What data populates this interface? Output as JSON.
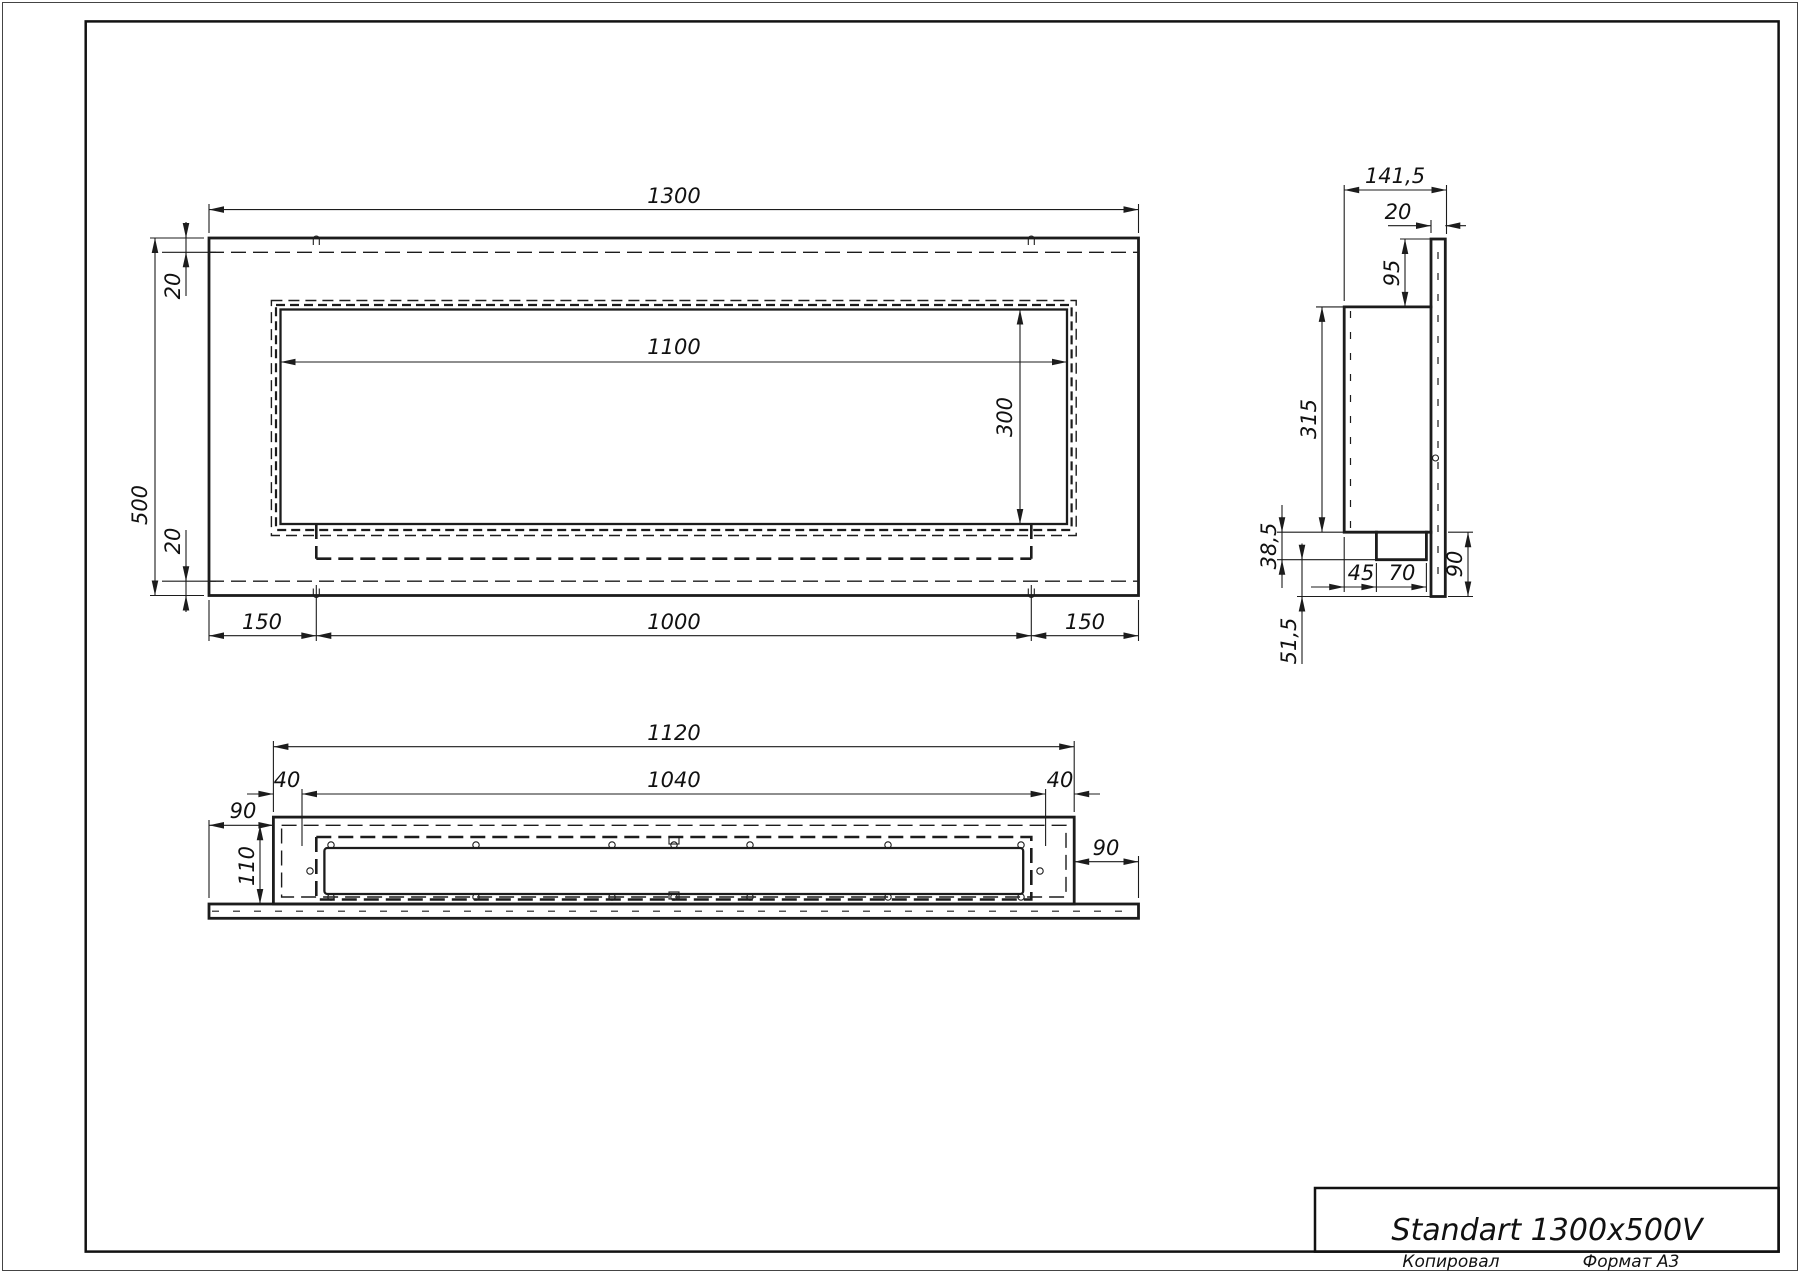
{
  "title_block": {
    "title": "Standart 1300x500V",
    "copied": "Копировал",
    "format": "Формат А3"
  },
  "front_view": {
    "width": "1300",
    "height": "500",
    "opening_width": "1100",
    "opening_height": "300",
    "edge_top": "20",
    "edge_bottom": "20",
    "left_margin": "150",
    "burner_width": "1000",
    "right_margin": "150"
  },
  "side_view": {
    "depth": "141,5",
    "panel_thickness": "20",
    "top_inset": "95",
    "body_height": "315",
    "step_height": "38,5",
    "bottom_inset": "51,5",
    "pocket_offset": "45",
    "pocket_depth": "70",
    "lower_height": "90"
  },
  "bottom_view": {
    "body_width": "1120",
    "inner_width": "1040",
    "inset_left": "40",
    "inset_right": "40",
    "overhang_left": "90",
    "inner_depth": "110",
    "overhang_right": "90"
  }
}
